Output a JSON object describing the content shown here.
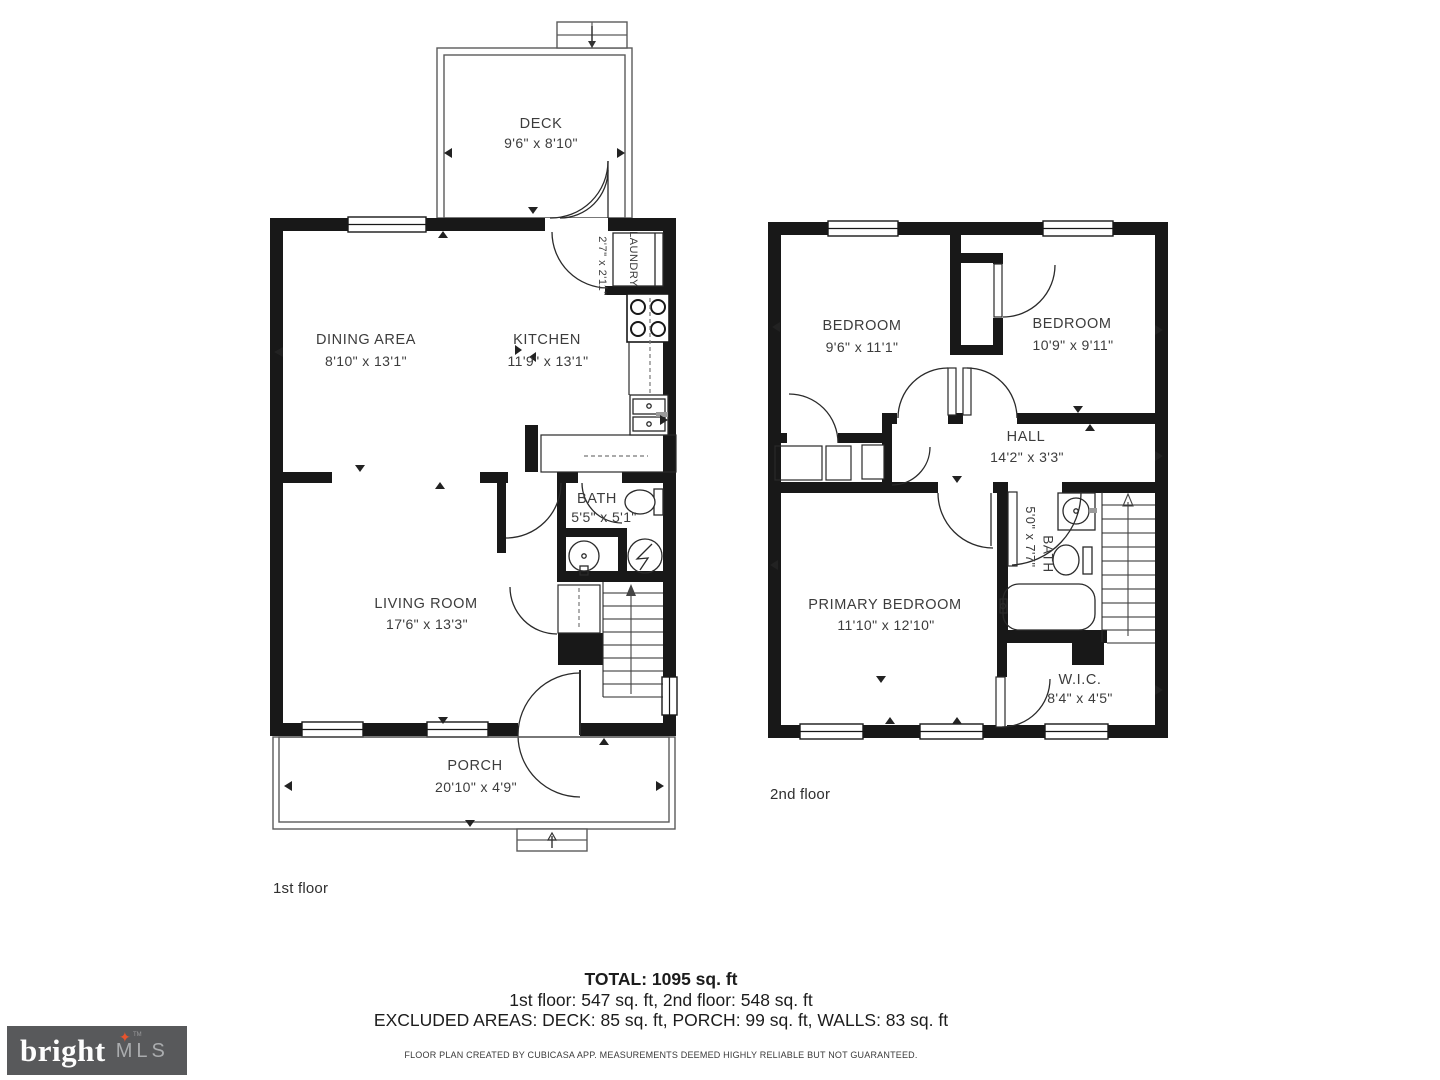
{
  "floors": {
    "first": {
      "label": "1st floor",
      "rooms": [
        {
          "name": "DECK",
          "dims": "9'6\" x 8'10\""
        },
        {
          "name": "DINING AREA",
          "dims": "8'10\" x 13'1\""
        },
        {
          "name": "KITCHEN",
          "dims": "11'9\" x 13'1\""
        },
        {
          "name": "LAUNDRY",
          "dims": "2'7\" x 2'11\""
        },
        {
          "name": "BATH",
          "dims": "5'5\" x 5'1\""
        },
        {
          "name": "LIVING ROOM",
          "dims": "17'6\" x 13'3\""
        },
        {
          "name": "PORCH",
          "dims": "20'10\" x 4'9\""
        }
      ]
    },
    "second": {
      "label": "2nd floor",
      "rooms": [
        {
          "name": "BEDROOM",
          "dims": "9'6\" x 11'1\""
        },
        {
          "name": "BEDROOM",
          "dims": "10'9\" x 9'11\""
        },
        {
          "name": "HALL",
          "dims": "14'2\" x 3'3\""
        },
        {
          "name": "BATH",
          "dims": "5'0\" x 7'7\""
        },
        {
          "name": "PRIMARY BEDROOM",
          "dims": "11'10\" x 12'10\""
        },
        {
          "name": "W.I.C.",
          "dims": "8'4\" x 4'5\""
        }
      ]
    }
  },
  "summary": {
    "total": "TOTAL: 1095 sq. ft",
    "floors_line": "1st floor: 547 sq. ft, 2nd floor: 548 sq. ft",
    "excluded_line": "EXCLUDED AREAS: DECK: 85 sq. ft, PORCH: 99 sq. ft, WALLS: 83 sq. ft",
    "disclaimer": "FLOOR PLAN CREATED BY CUBICASA APP. MEASUREMENTS DEEMED HIGHLY RELIABLE BUT NOT GUARANTEED."
  },
  "logo": {
    "brand": "bright",
    "suffix": "MLS",
    "star": "✦",
    "tm": "TM"
  },
  "colors": {
    "wall": "#181818",
    "thin_outline": "#5a5a5a",
    "text": "#3c3c3c",
    "logo_bg": "#58595b",
    "logo_star": "#e8542e",
    "logo_mls": "#aaacae"
  }
}
